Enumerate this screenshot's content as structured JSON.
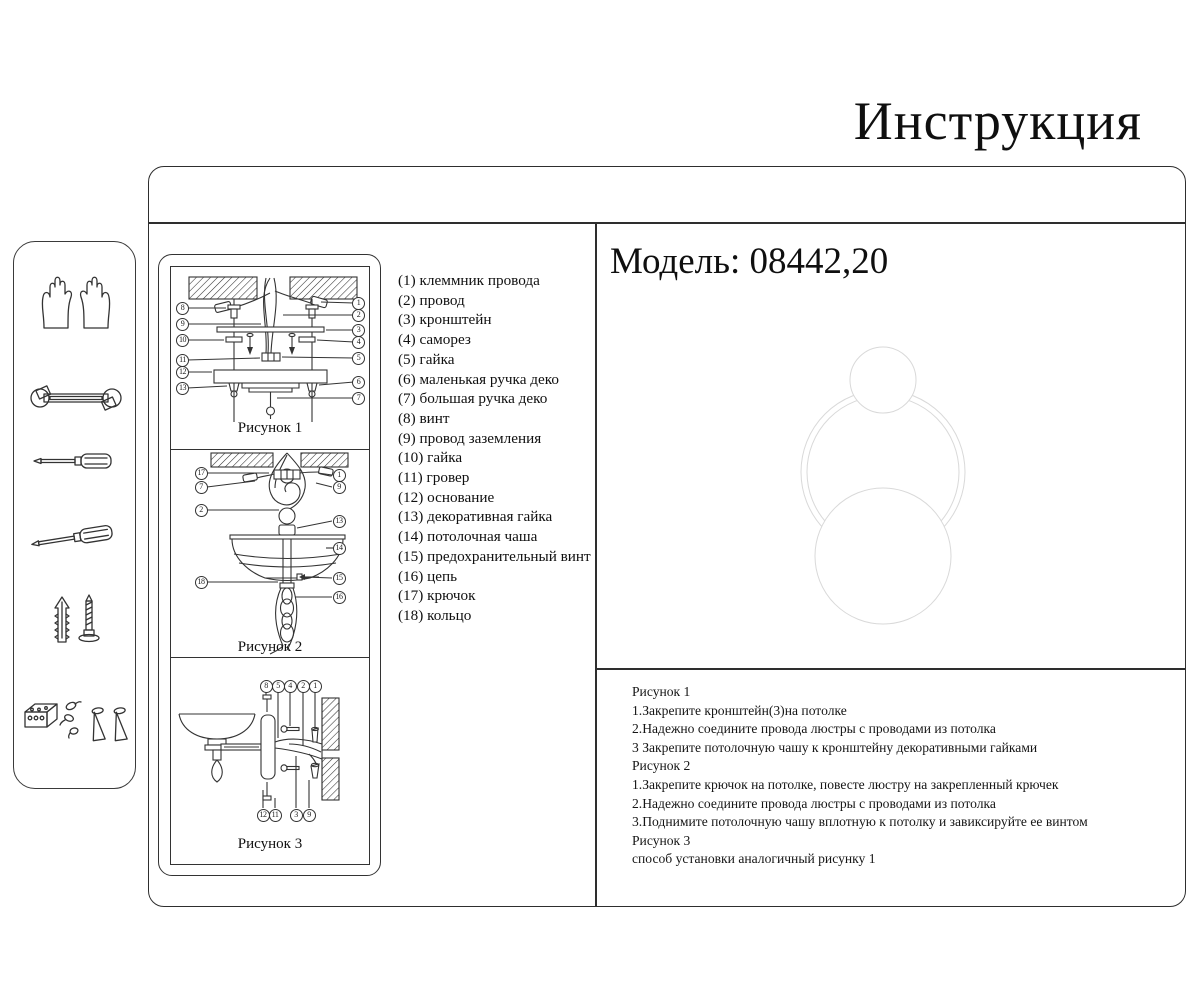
{
  "title": "Инструкция",
  "model": {
    "label": "Модель: 08442,20"
  },
  "sidebar": {
    "tools": [
      {
        "name": "gloves"
      },
      {
        "name": "wrench"
      },
      {
        "name": "screwdriver-flat"
      },
      {
        "name": "screwdriver-tilted"
      },
      {
        "name": "wall-plug-and-screw"
      },
      {
        "name": "terminal-block-and-anchors"
      }
    ]
  },
  "figures": [
    {
      "caption": "Рисунок 1",
      "callouts_left": [
        "8",
        "9",
        "10",
        "11",
        "12",
        "13"
      ],
      "callouts_right": [
        "1",
        "2",
        "3",
        "4",
        "5",
        "6",
        "7"
      ]
    },
    {
      "caption": "Рисунок 2",
      "callouts_left": [
        "17",
        "7",
        "2",
        "18"
      ],
      "callouts_right": [
        "1",
        "9",
        "13",
        "14",
        "15",
        "16"
      ]
    },
    {
      "caption": "Рисунок 3",
      "callouts_top": [
        "8",
        "5",
        "4",
        "2",
        "1"
      ],
      "callouts_bottom": [
        "12",
        "11",
        "3",
        "9"
      ]
    }
  ],
  "parts": {
    "items": [
      "(1) клеммник провода",
      "(2) провод",
      "(3) кронштейн",
      "(4) саморез",
      "(5) гайка",
      "(6) маленькая ручка деко",
      "(7) большая ручка деко",
      "(8) винт",
      "(9) провод заземления",
      "(10) гайка",
      "(11) гровер",
      "(12) основание",
      "(13) декоративная гайка",
      "(14) потолочная чаша",
      "(15) предохранительный винт",
      "(16) цепь",
      "(17) крючок",
      "(18) кольцо"
    ]
  },
  "instructions": {
    "lines": [
      "Рисунок 1",
      "1.Закрепите кронштейн(3)на потолке",
      "2.Надежно соедините провода люстры с проводами из потолка",
      "3 Закрепите потолочную чашу к кронштейну декоративными гайками",
      "Рисунок 2",
      "1.Закрепите крючок на потолке, повесте люстру на закрепленный крючек",
      "2.Надежно соедините провода люстры с проводами из потолка",
      "3.Поднимите потолочную чашу вплотную к потолку и завиксируйте ее винтом",
      "Рисунок 3",
      "способ установки аналогичный рисунку 1"
    ]
  },
  "colors": {
    "ink": "#2e2e2e",
    "watermark": "#d9d9d9"
  }
}
